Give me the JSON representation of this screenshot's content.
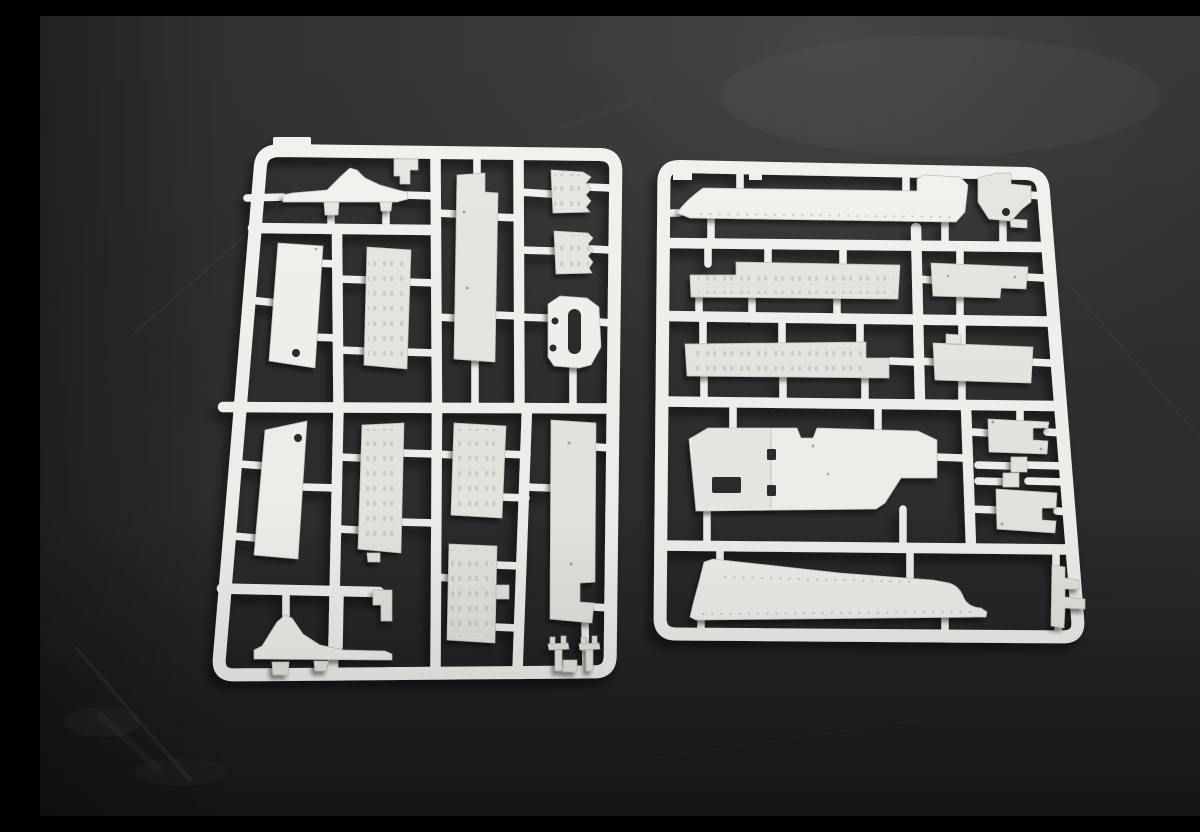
{
  "scene": {
    "type": "photograph",
    "caption": "Two white polystyrene model-kit sprues (parts frames) holding flat hull panels, riveted plates, fenders and small brackets, lying on a dark charcoal surface",
    "material": "white polystyrene plastic",
    "surface": "dark charcoal studio background",
    "objects": [
      {
        "id": "left-sprue",
        "label": "Left sprue frame",
        "description": "Upright rounded-rectangle runner frame holding two curved fender strips, plain side panels with locating holes, riveted panels, a slotted shackle bracket and two small pin parts",
        "part_count": 19
      },
      {
        "id": "right-sprue",
        "label": "Right sprue frame",
        "description": "Rounded-rectangle runner frame holding long hull side strips, riveted stringers, deck plates with cutouts, a large hull floor piece and small corner brackets",
        "part_count": 14
      }
    ]
  },
  "colors": {
    "bg-base": "#323231",
    "bg-light": "#555553",
    "bg-dark": "#141414",
    "plastic-bright": "#f3f2ee",
    "plastic-face": "#e8e7e2",
    "plastic-dim": "#dcdbd6",
    "plastic-edge": "#c2c1bc",
    "rivet": "#c4c3be",
    "hole": "#2c2c2b",
    "shadow": "#000000"
  }
}
